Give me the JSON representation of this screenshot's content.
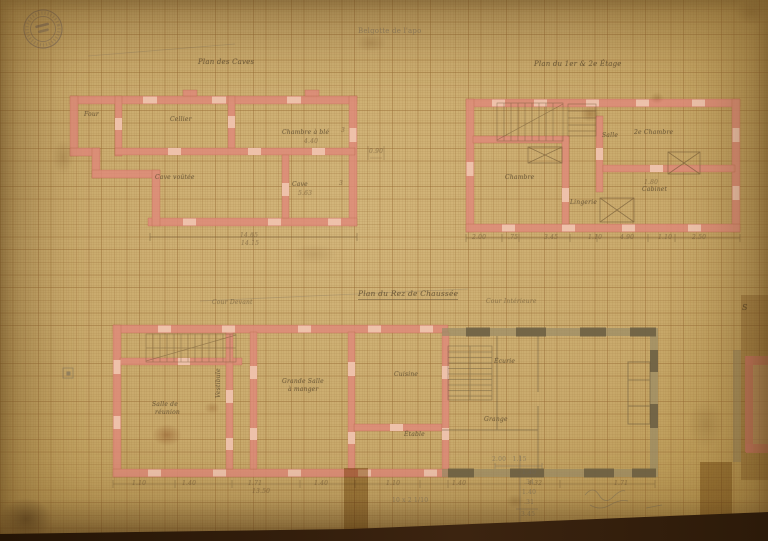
{
  "meta": {
    "artifact": "Scanned hand-drawn architectural floor plans in pink and grey wash on aged millimeter graph paper",
    "language": "French"
  },
  "palette": {
    "paper": "#c9aa6c",
    "grid": "#a98753",
    "new_masonry_pink": "#df8b7a",
    "opening_light_pink": "#efc4ad",
    "existing_masonry_grey": "#9a8c66",
    "pier_dark_grey": "#6b5e42",
    "ink_sepia": "#5c4a2e",
    "pencil_grey": "#6e675c",
    "scan_background": "#2c1a09"
  },
  "stamp": {
    "shape": "circular",
    "position": "top-left",
    "legibility": "illegible",
    "ink": "#4a4458"
  },
  "plans": [
    {
      "title": "Plan des Caves",
      "rooms": [
        "Four",
        "Cellier",
        "Chambre à blé",
        "Cave voûtée",
        "Cave"
      ],
      "dimensions": [
        "4.40",
        "5.63",
        "14.65",
        "14.15",
        "3",
        "3",
        "0.90"
      ]
    },
    {
      "title": "Plan du 1er & 2e Étage",
      "rooms": [
        "Chambre",
        "Salle",
        "2e Chambre",
        "Cabinet",
        "Lingerie"
      ],
      "dimensions": [
        "1.80",
        "2.00",
        ".75",
        "3.45",
        "1.10",
        "4.90",
        "1.10",
        "2.50"
      ]
    },
    {
      "title": "Plan du Rez de Chaussée",
      "rooms": [
        "Salle de réunion",
        "Vestibule",
        "Grande Salle à manger",
        "Cuisine",
        "Étable",
        "Écurie",
        "Grange"
      ],
      "dimensions": [
        "1.10",
        "1.40",
        "1.71",
        "1.40",
        "1.10",
        "1.40",
        "4.32",
        "1.71",
        "13.50"
      ]
    }
  ],
  "pencil_notes": [
    "Belgotte de l'apo",
    "2.00   1.15",
    "1.40",
    ".34",
    "1.40",
    ".31",
    "3.45",
    "10 x 2 1/10"
  ],
  "labels": [
    {
      "name": "pencil-note-top",
      "text": "Belgotte de l'apo",
      "x": 358,
      "y": 28,
      "size": 7,
      "cls": "pencil faint"
    },
    {
      "name": "plan-caves-title",
      "text": "Plan des Caves",
      "x": 198,
      "y": 59,
      "size": 7,
      "cls": "ink"
    },
    {
      "name": "plan-etage-title",
      "text": "Plan du 1er & 2e Étage",
      "x": 534,
      "y": 61,
      "size": 7,
      "cls": "ink"
    },
    {
      "name": "plan-rdc-title",
      "text": "Plan du Rez de Chaussée",
      "x": 358,
      "y": 290,
      "size": 7.5,
      "cls": "ink u"
    },
    {
      "name": "note-cour-devant",
      "text": "Cour Devant",
      "x": 212,
      "y": 300,
      "size": 6,
      "cls": "ink faint"
    },
    {
      "name": "note-cour-interieure",
      "text": "Cour Intérieure",
      "x": 486,
      "y": 299,
      "size": 6,
      "cls": "ink faint"
    },
    {
      "name": "letter-s",
      "text": "S",
      "x": 742,
      "y": 304,
      "size": 8,
      "cls": "ink"
    },
    {
      "name": "room-four",
      "text": "Four",
      "x": 84,
      "y": 112,
      "size": 6,
      "cls": "ink"
    },
    {
      "name": "room-cellier",
      "text": "Cellier",
      "x": 170,
      "y": 117,
      "size": 6,
      "cls": "ink"
    },
    {
      "name": "room-chambre-ble",
      "text": "Chambre à blé",
      "x": 282,
      "y": 130,
      "size": 6,
      "cls": "ink"
    },
    {
      "name": "dim-440",
      "text": "4.40",
      "x": 304,
      "y": 139,
      "size": 6,
      "cls": "dim"
    },
    {
      "name": "room-cave-voutee",
      "text": "Cave voûtée",
      "x": 155,
      "y": 175,
      "size": 6,
      "cls": "ink"
    },
    {
      "name": "room-cave",
      "text": "Cave",
      "x": 292,
      "y": 182,
      "size": 6,
      "cls": "ink"
    },
    {
      "name": "dim-563",
      "text": "5.63",
      "x": 298,
      "y": 191,
      "size": 6,
      "cls": "dim"
    },
    {
      "name": "dim-1465",
      "text": "14.65",
      "x": 240,
      "y": 233,
      "size": 6,
      "cls": "dim"
    },
    {
      "name": "dim-1415",
      "text": "14.15",
      "x": 241,
      "y": 241,
      "size": 6,
      "cls": "dim"
    },
    {
      "name": "dim-3a",
      "text": "3",
      "x": 341,
      "y": 128,
      "size": 6,
      "cls": "dim"
    },
    {
      "name": "dim-3b",
      "text": "3",
      "x": 339,
      "y": 181,
      "size": 6,
      "cls": "dim"
    },
    {
      "name": "dim-090",
      "text": "0.90",
      "x": 369,
      "y": 149,
      "size": 6,
      "cls": "dim"
    },
    {
      "name": "room-chambre",
      "text": "Chambre",
      "x": 505,
      "y": 175,
      "size": 6,
      "cls": "ink"
    },
    {
      "name": "room-salle",
      "text": "Salle",
      "x": 602,
      "y": 133,
      "size": 6,
      "cls": "ink"
    },
    {
      "name": "room-2e-chambre",
      "text": "2e Chambre",
      "x": 634,
      "y": 130,
      "size": 6,
      "cls": "ink"
    },
    {
      "name": "room-cabinet",
      "text": "Cabinet",
      "x": 642,
      "y": 187,
      "size": 6,
      "cls": "ink"
    },
    {
      "name": "room-lingerie",
      "text": "Lingerie",
      "x": 570,
      "y": 200,
      "size": 6,
      "cls": "ink"
    },
    {
      "name": "dim-180",
      "text": "1.80",
      "x": 644,
      "y": 180,
      "size": 6,
      "cls": "dim"
    },
    {
      "name": "dim-p2-1",
      "text": "2.00",
      "x": 472,
      "y": 235,
      "size": 6,
      "cls": "dim"
    },
    {
      "name": "dim-p2-2",
      "text": ".75",
      "x": 508,
      "y": 235,
      "size": 6,
      "cls": "dim"
    },
    {
      "name": "dim-p2-3",
      "text": "3.45",
      "x": 544,
      "y": 235,
      "size": 6,
      "cls": "dim"
    },
    {
      "name": "dim-p2-4",
      "text": "1.10",
      "x": 588,
      "y": 235,
      "size": 6,
      "cls": "dim"
    },
    {
      "name": "dim-p2-5",
      "text": "4.90",
      "x": 620,
      "y": 235,
      "size": 6,
      "cls": "dim"
    },
    {
      "name": "dim-p2-6",
      "text": "1.10",
      "x": 658,
      "y": 235,
      "size": 6,
      "cls": "dim"
    },
    {
      "name": "dim-p2-7",
      "text": "2.50",
      "x": 692,
      "y": 235,
      "size": 6,
      "cls": "dim"
    },
    {
      "name": "room-salle-de",
      "text": "Salle de",
      "x": 152,
      "y": 402,
      "size": 6,
      "cls": "ink"
    },
    {
      "name": "room-reunion",
      "text": "réunion",
      "x": 155,
      "y": 410,
      "size": 6,
      "cls": "ink"
    },
    {
      "name": "room-vestibule",
      "text": "Vestibule",
      "x": 216,
      "y": 398,
      "size": 6,
      "cls": "ink vert"
    },
    {
      "name": "room-grande-salle",
      "text": "Grande Salle",
      "x": 282,
      "y": 379,
      "size": 6,
      "cls": "ink"
    },
    {
      "name": "room-a-manger",
      "text": "à manger",
      "x": 288,
      "y": 387,
      "size": 6,
      "cls": "ink"
    },
    {
      "name": "room-cuisine",
      "text": "Cuisine",
      "x": 394,
      "y": 372,
      "size": 6,
      "cls": "ink"
    },
    {
      "name": "room-etable",
      "text": "Étable",
      "x": 404,
      "y": 432,
      "size": 6,
      "cls": "ink"
    },
    {
      "name": "room-ecurie",
      "text": "Écurie",
      "x": 494,
      "y": 359,
      "size": 6,
      "cls": "ink"
    },
    {
      "name": "room-grange",
      "text": "Grange",
      "x": 484,
      "y": 417,
      "size": 6,
      "cls": "ink"
    },
    {
      "name": "dim-p3-1",
      "text": "1.10",
      "x": 132,
      "y": 481,
      "size": 6,
      "cls": "dim faint"
    },
    {
      "name": "dim-p3-2",
      "text": "1.40",
      "x": 182,
      "y": 481,
      "size": 6,
      "cls": "dim faint"
    },
    {
      "name": "dim-p3-3",
      "text": "1.71",
      "x": 248,
      "y": 481,
      "size": 6,
      "cls": "dim faint"
    },
    {
      "name": "dim-p3-4",
      "text": "1.40",
      "x": 314,
      "y": 481,
      "size": 6,
      "cls": "dim faint"
    },
    {
      "name": "dim-p3-5",
      "text": "1.10",
      "x": 386,
      "y": 481,
      "size": 6,
      "cls": "dim faint"
    },
    {
      "name": "dim-p3-6",
      "text": "1.40",
      "x": 452,
      "y": 481,
      "size": 6,
      "cls": "dim faint"
    },
    {
      "name": "dim-p3-7",
      "text": "4.32",
      "x": 528,
      "y": 481,
      "size": 6,
      "cls": "dim faint"
    },
    {
      "name": "dim-p3-8",
      "text": "1.71",
      "x": 614,
      "y": 481,
      "size": 6,
      "cls": "dim faint"
    },
    {
      "name": "dim-1350",
      "text": "13.50",
      "x": 252,
      "y": 489,
      "size": 6,
      "cls": "dim"
    },
    {
      "name": "pencil-dim-200-115",
      "text": "2.00   1.15",
      "x": 492,
      "y": 457,
      "size": 6,
      "cls": "pencil"
    },
    {
      "name": "pencil-col-1",
      "text": "1.40",
      "x": 522,
      "y": 470,
      "size": 6,
      "cls": "pencil"
    },
    {
      "name": "pencil-col-2",
      "text": ".34",
      "x": 524,
      "y": 480,
      "size": 6,
      "cls": "pencil"
    },
    {
      "name": "pencil-col-3",
      "text": "1.40",
      "x": 522,
      "y": 490,
      "size": 6,
      "cls": "pencil"
    },
    {
      "name": "pencil-col-4",
      "text": ".31",
      "x": 524,
      "y": 500,
      "size": 6,
      "cls": "pencil"
    },
    {
      "name": "pencil-col-sum",
      "text": "3.45",
      "x": 521,
      "y": 512,
      "size": 6,
      "cls": "pencil"
    },
    {
      "name": "pencil-note-10x2",
      "text": "10 x 2 1/10",
      "x": 392,
      "y": 498,
      "size": 6,
      "cls": "pencil"
    }
  ]
}
